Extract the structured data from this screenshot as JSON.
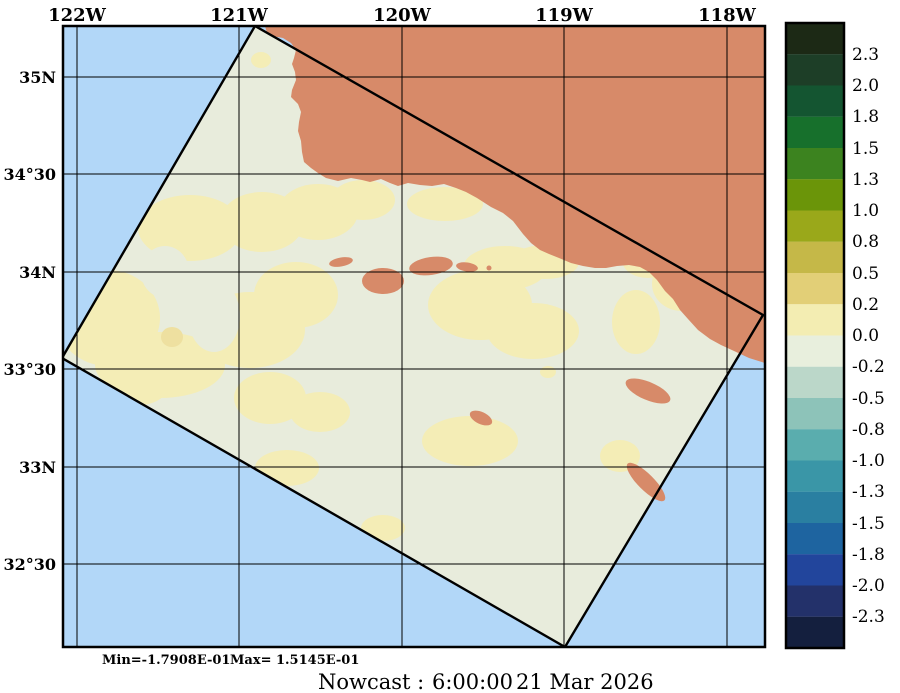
{
  "figure": {
    "min_stat": "Min=-1.7908E-01",
    "max_stat": "Max= 1.5145E-01",
    "caption_label": "Nowcast :",
    "caption_time": "6:00:00",
    "caption_date": "21 Mar 2026"
  },
  "axes": {
    "top_ticks": [
      "122W",
      "121W",
      "120W",
      "119W",
      "118W"
    ],
    "left_ticks": [
      "35N",
      "34°30",
      "34N",
      "33°30",
      "33N",
      "32°30"
    ]
  },
  "colorbar": {
    "tick_labels": [
      "2.3",
      "2.0",
      "1.8",
      "1.5",
      "1.3",
      "1.0",
      "0.8",
      "0.5",
      "0.2",
      "0.0",
      "-0.2",
      "-0.5",
      "-0.8",
      "-1.0",
      "-1.3",
      "-1.5",
      "-1.8",
      "-2.0",
      "-2.3"
    ],
    "segment_colors": [
      "#1c2915",
      "#1d3e27",
      "#145531",
      "#17702c",
      "#3c831f",
      "#6b9509",
      "#9aa81a",
      "#c5b848",
      "#e2cf77",
      "#f3edb2",
      "#e8efdd",
      "#bbd7c9",
      "#8dc3b9",
      "#5aadae",
      "#3a96a7",
      "#2a7fa1",
      "#1e64a0",
      "#22459c",
      "#23316a",
      "#141f3e"
    ]
  },
  "map": {
    "colors": {
      "ocean": "#b2d7f8",
      "land": "#d78a69",
      "field_low": "#e8ecdc",
      "field_mid": "#f4edb6",
      "field_dot": "#eee0a0"
    }
  }
}
